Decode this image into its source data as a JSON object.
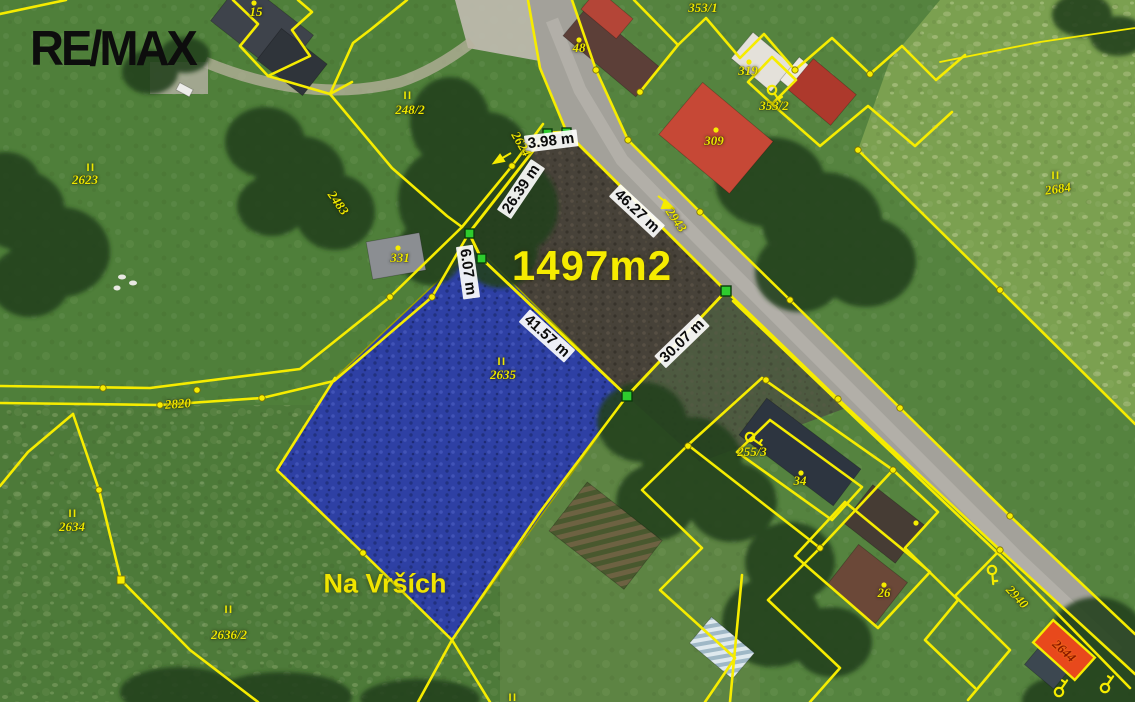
{
  "branding": {
    "logo_text": "RE/MAX"
  },
  "map": {
    "area_label": "1497m2",
    "place_name": "Na Vrších",
    "land_use_symbol": "II",
    "measurements": {
      "top_edge": "3.98 m",
      "upper_left_edge": "26.39 m",
      "lower_left_edge": "6.07 m",
      "road_edge": "46.27 m",
      "diagonal_edge": "41.57 m",
      "lower_right_edge": "30.07 m"
    },
    "parcel_numbers": {
      "p15": "15",
      "p48": "48",
      "p248_2": "248/2",
      "p2623": "2623",
      "p2483": "2483",
      "p331": "331",
      "p2624": "2624",
      "p2820": "2820",
      "p2635": "2635",
      "p2634": "2634",
      "p2636_2": "2636/2",
      "p2684": "2684",
      "p353_1": "353/1",
      "p353_2": "353/2",
      "p309": "309",
      "p319": "319",
      "p255_3": "255/3",
      "p34": "34",
      "p26": "26",
      "p2943": "2943",
      "p2940": "2940",
      "p2644": "2644"
    },
    "colors": {
      "cadastral_line": "#f6ec00",
      "label_yellow": "#ede700",
      "highlight_parcel_blue": "#2e40a4",
      "target_parcel_dark": "#474239",
      "vertex_green": "#2ecc2e",
      "highlight_red": "#e8491c"
    }
  }
}
